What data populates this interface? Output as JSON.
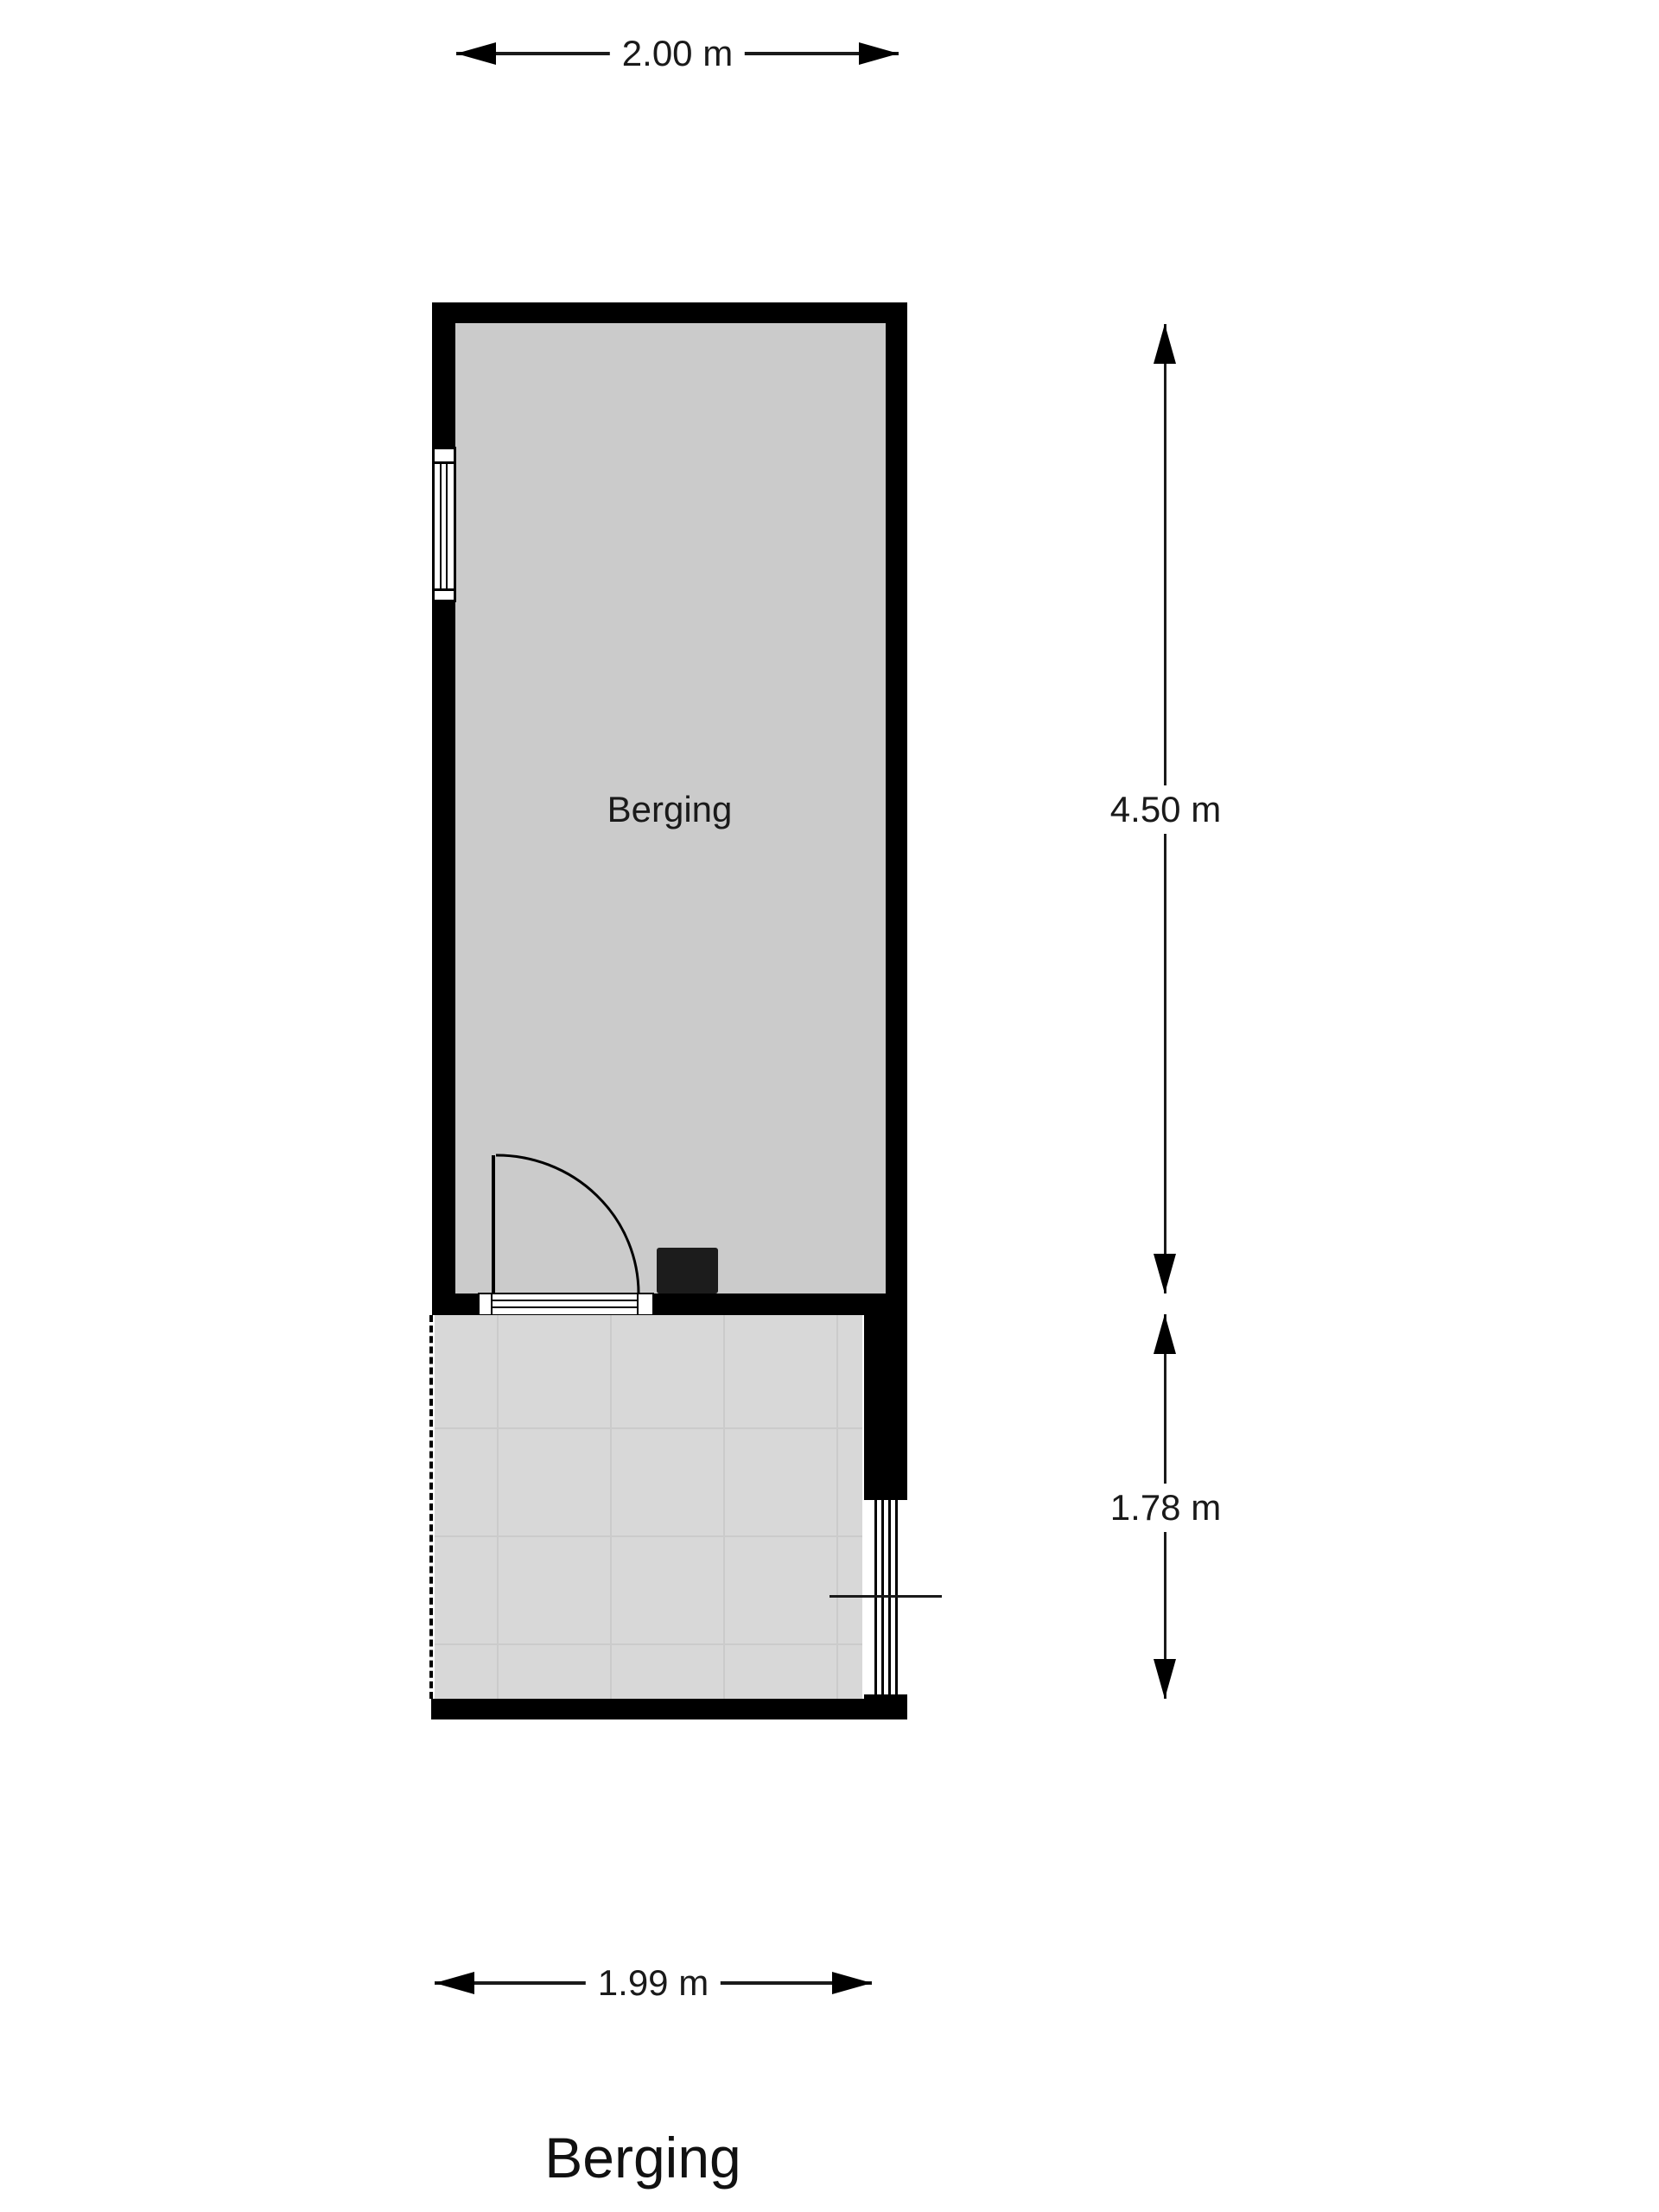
{
  "floorplan": {
    "title": "Berging",
    "room": {
      "label": "Berging"
    },
    "dimensions": {
      "top": "2.00 m",
      "main_height": "4.50 m",
      "lower_height": "1.78 m",
      "bottom": "1.99 m"
    },
    "colors": {
      "wall": "#000000",
      "room_fill": "#cbcbcb",
      "terrace_fill": "#d8d8d8",
      "background": "#ffffff",
      "text": "#1a1a1a"
    }
  }
}
